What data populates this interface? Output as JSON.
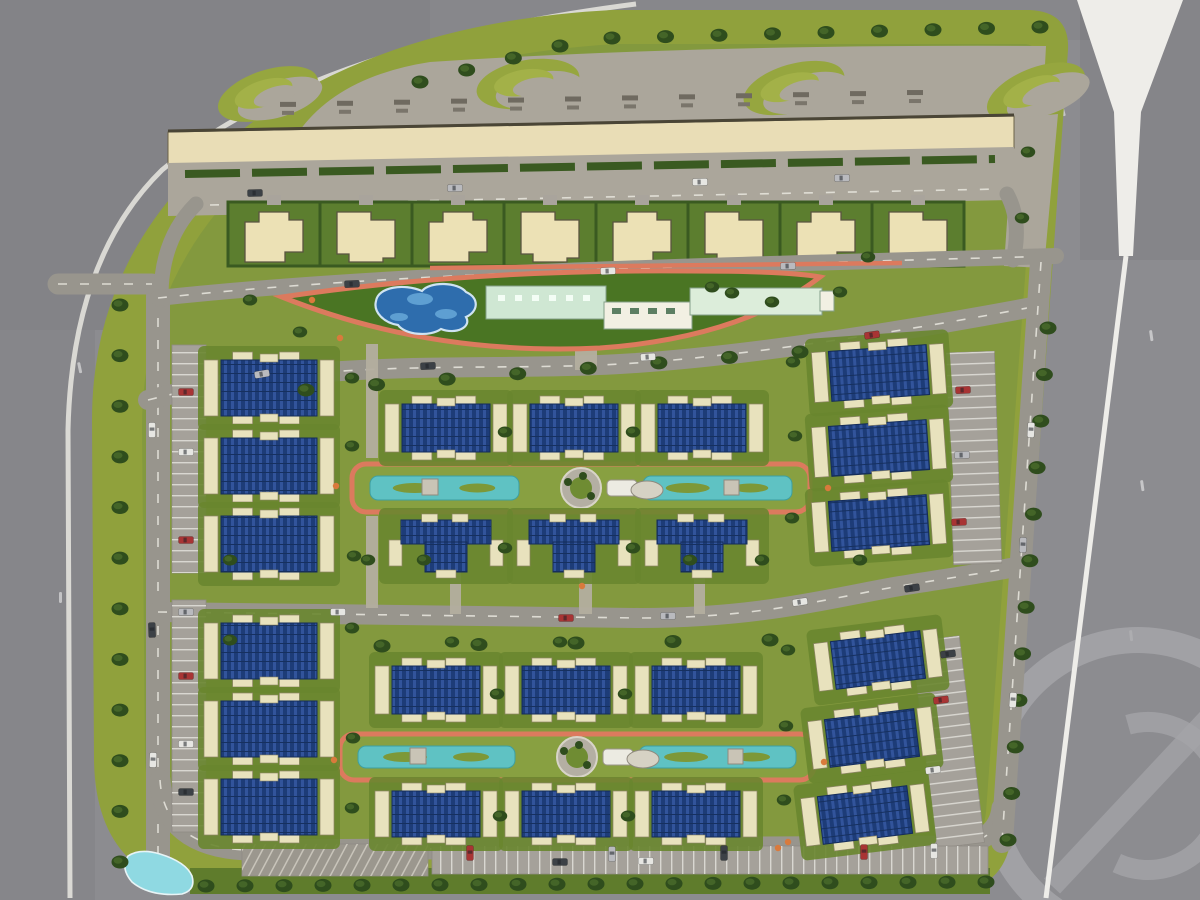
{
  "meta": {
    "description": "aerial master plan rendering of a gated residential compound",
    "canvas": {
      "w": 1200,
      "h": 900
    }
  },
  "colors": {
    "asphalt": "#8c8c90",
    "asphalt_dark": "#7e7e83",
    "belt_green": "#90a13c",
    "lawn": "#83993e",
    "lawn_dark": "#69862f",
    "amenity_lawn": "#4a7523",
    "hedge": "#3a5a21",
    "tree_dark": "#2f4d1d",
    "tree_mid": "#47682a",
    "paving": "#aba69b",
    "walkway": "#b3ae9f",
    "road": "#98958d",
    "road_dash": "#e9e7df",
    "curb_white": "#e9e7e0",
    "white_road": "#eeede9",
    "retail_beige": "#e9ddb6",
    "retail_edge": "#4a4536",
    "villa_tan": "#ece1b5",
    "villa_edge": "#5a5440",
    "villa_plot": "#5c7e2f",
    "bldg_cream": "#e8e2bd",
    "bldg_cream_edge": "#8d8566",
    "roof_navy": "#1d3c78",
    "roof_stripe": "#32549b",
    "roof_edge": "#142c5a",
    "track_orange": "#dc7a5e",
    "shrub_orange": "#d97a3c",
    "pool_blue": "#2e6dad",
    "pool_light": "#6aabdb",
    "pool_rim": "#cfe3f2",
    "canal_teal": "#5fc2c3",
    "canal_edge": "#3e9fa0",
    "park_lawn": "#88a041",
    "mint": "#cfe7d3",
    "mint2": "#dcedda",
    "club_white": "#f2f0e3",
    "club_edge": "#84a08a",
    "pond": "#8fd9e2",
    "pond_rim": "#e8f4f6",
    "lane": "#a5a19a",
    "stall_line": "#d9d7d1",
    "watermark": "#a6a6aa",
    "car": {
      "red": "#a83434",
      "white": "#e6e6e2",
      "silver": "#b9babe",
      "dark": "#3c4146",
      "green": "#31472a"
    }
  },
  "map": {
    "compound": "M 612,10 L 1030,10 Q 1070,12 1068,50 L 1012,830 Q 1008,890 948,893 L 235,893 Q 96,893 94,760 L 92,420 Q 92,240 250,124 Q 390,22 612,10 Z",
    "interior": "M 615,44 L 1026,44 Q 1041,46 1040,72 L 986,812 Q 982,850 944,852 L 250,852 Q 146,852 145,756 L 142,428 Q 142,256 286,146 Q 398,58 615,44 Z",
    "patches": [
      [
        0,
        0,
        430,
        330,
        0.06
      ],
      [
        0,
        330,
        95,
        570,
        0.04
      ],
      [
        1080,
        0,
        120,
        260,
        0.045
      ],
      [
        430,
        0,
        660,
        40,
        0.03
      ]
    ],
    "plaza": "M 300,130 Q 340,76 430,62 Q 700,44 1046,46 L 1042,122 L 1014,118 L 170,136 Z",
    "swirls": [
      [
        268,
        94,
        -18
      ],
      [
        528,
        84,
        -10
      ],
      [
        794,
        88,
        -16
      ],
      [
        1036,
        92,
        -22
      ]
    ],
    "labels": {
      "x0": 280,
      "step": 57,
      "n": 12
    },
    "retail": {
      "pts": "168,132 1014,116 1014,148 168,164",
      "topline": [
        [
          168,
          131
        ],
        [
          1014,
          115
        ]
      ]
    },
    "midband": {
      "pts": "168,163 1014,147 1012,200 168,216",
      "hedge": [
        [
          185,
          174
        ],
        [
          995,
          159
        ]
      ],
      "dash": [
        [
          210,
          205
        ],
        [
          1000,
          189
        ]
      ]
    },
    "villas": {
      "x0": 228,
      "step": 92,
      "n": 8,
      "y": 202,
      "h": 64
    },
    "pads": [
      "1014,118 1058,114 1044,268 1004,266"
    ],
    "amenity": {
      "lens": "M 282,297 Q 470,269 690,271 Q 790,271 820,277 Q 740,338 600,348 Q 430,356 282,297 Z",
      "topline": "M 430,268 L 902,263",
      "pool": "M 376,301 C 378,287 404,283 422,291 C 430,281 458,282 466,292 C 480,298 478,312 466,317 C 472,327 456,335 441,329 C 430,337 405,335 398,325 C 384,323 373,312 376,301 Z",
      "pool_inner": [
        [
          420,
          299,
          13,
          6
        ],
        [
          446,
          314,
          11,
          5
        ],
        [
          399,
          317,
          9,
          4
        ]
      ],
      "club": [
        [
          486,
          286,
          120,
          33,
          "m"
        ],
        [
          604,
          302,
          88,
          27,
          "w"
        ],
        [
          690,
          288,
          132,
          27,
          "m2"
        ],
        [
          820,
          291,
          14,
          20,
          "w"
        ]
      ]
    },
    "roads": [
      {
        "d": "M 158,296 L 158,862",
        "w": 24,
        "dash": 1
      },
      {
        "d": "M 58,284 L 152,284",
        "w": 21,
        "dash": 1
      },
      {
        "d": "M 196,204 Q 160,240 161,300",
        "w": 15
      },
      {
        "d": "M 1007,194 Q 1022,222 1013,260",
        "w": 15
      },
      {
        "d": "M 158,298 C 400,272 700,266 1056,256",
        "w": 16,
        "dash": 1
      },
      {
        "d": "M 148,400 C 320,356 480,372 620,364 C 740,357 900,332 1038,306",
        "w": 20,
        "dash": 1
      },
      {
        "d": "M 158,612 L 640,618 C 760,618 830,598 900,586 C 950,578 990,572 1010,568",
        "w": 20,
        "dash": 1
      },
      {
        "d": "M 160,780 Q 164,846 246,850 L 948,846 Q 998,844 1002,808",
        "w": 21,
        "dash": 1
      },
      {
        "d": "M 1041,262 L 1002,842",
        "w": 22,
        "dash": 1
      }
    ],
    "walkways": [
      [
        366,
        344,
        12,
        114
      ],
      [
        366,
        516,
        12,
        92
      ],
      [
        575,
        298,
        22,
        72
      ],
      [
        450,
        562,
        11,
        52
      ],
      [
        579,
        562,
        13,
        52
      ],
      [
        694,
        562,
        11,
        52
      ]
    ],
    "parks": [
      {
        "x": 352,
        "y": 464,
        "w": 458,
        "h": 48
      },
      {
        "x": 340,
        "y": 734,
        "w": 474,
        "h": 46
      }
    ],
    "parking": [
      {
        "x": 172,
        "y": 345,
        "w": 34,
        "h": 228,
        "o": "h"
      },
      {
        "x": 172,
        "y": 600,
        "w": 34,
        "h": 232,
        "o": "h"
      },
      {
        "x": 950,
        "y": 352,
        "w": 48,
        "h": 212,
        "o": "h",
        "r": -2
      },
      {
        "x": 924,
        "y": 638,
        "w": 48,
        "h": 208,
        "o": "h",
        "r": -7
      },
      {
        "x": 432,
        "y": 846,
        "w": 556,
        "h": 28,
        "o": "v"
      },
      {
        "x": 242,
        "y": 844,
        "w": 186,
        "h": 32,
        "o": "x"
      }
    ],
    "buildings": [
      {
        "t": "f",
        "x": 204,
        "y": 352,
        "w": 130,
        "h": 72,
        "r": 0
      },
      {
        "t": "f",
        "x": 204,
        "y": 430,
        "w": 130,
        "h": 72,
        "r": 0
      },
      {
        "t": "f",
        "x": 204,
        "y": 508,
        "w": 130,
        "h": 72,
        "r": 0
      },
      {
        "t": "f",
        "x": 204,
        "y": 615,
        "w": 130,
        "h": 72,
        "r": 0
      },
      {
        "t": "f",
        "x": 204,
        "y": 693,
        "w": 130,
        "h": 72,
        "r": 0
      },
      {
        "t": "f",
        "x": 204,
        "y": 771,
        "w": 130,
        "h": 72,
        "r": 0
      },
      {
        "t": "f",
        "x": 385,
        "y": 396,
        "w": 122,
        "h": 64,
        "r": 0
      },
      {
        "t": "f",
        "x": 513,
        "y": 396,
        "w": 122,
        "h": 64,
        "r": 0
      },
      {
        "t": "f",
        "x": 641,
        "y": 396,
        "w": 122,
        "h": 64,
        "r": 0
      },
      {
        "t": "c",
        "x": 385,
        "y": 514,
        "w": 122,
        "h": 64,
        "r": 0
      },
      {
        "t": "c",
        "x": 513,
        "y": 514,
        "w": 122,
        "h": 64,
        "r": 0
      },
      {
        "t": "c",
        "x": 641,
        "y": 514,
        "w": 122,
        "h": 64,
        "r": 0
      },
      {
        "t": "f",
        "x": 375,
        "y": 658,
        "w": 122,
        "h": 64,
        "r": 0
      },
      {
        "t": "f",
        "x": 505,
        "y": 658,
        "w": 122,
        "h": 64,
        "r": 0
      },
      {
        "t": "f",
        "x": 635,
        "y": 658,
        "w": 122,
        "h": 64,
        "r": 0
      },
      {
        "t": "f",
        "x": 375,
        "y": 783,
        "w": 122,
        "h": 62,
        "r": 0
      },
      {
        "t": "f",
        "x": 505,
        "y": 783,
        "w": 122,
        "h": 62,
        "r": 0
      },
      {
        "t": "f",
        "x": 635,
        "y": 783,
        "w": 122,
        "h": 62,
        "r": 0
      },
      {
        "t": "f",
        "x": 813,
        "y": 340,
        "w": 132,
        "h": 66,
        "r": -4
      },
      {
        "t": "f",
        "x": 813,
        "y": 415,
        "w": 132,
        "h": 66,
        "r": -4
      },
      {
        "t": "f",
        "x": 813,
        "y": 490,
        "w": 132,
        "h": 66,
        "r": -4
      },
      {
        "t": "f",
        "x": 816,
        "y": 628,
        "w": 124,
        "h": 64,
        "r": -7
      },
      {
        "t": "f",
        "x": 810,
        "y": 706,
        "w": 124,
        "h": 64,
        "r": -7
      },
      {
        "t": "f",
        "x": 803,
        "y": 783,
        "w": 124,
        "h": 64,
        "r": -7
      }
    ],
    "pond": "M 128,856 Q 120,868 132,882 Q 150,897 182,894 Q 196,890 192,876 Q 186,862 160,854 Q 140,848 128,856 Z",
    "bottomstrip": [
      190,
      868,
      800,
      26
    ],
    "whiteroad": {
      "trumpet": "1077,0 1183,0 1141,112 1133,256 1119,256 1114,112",
      "line": "M 1126,256 L 1046,898",
      "lw": 5
    },
    "curb": "M 636,4 Q 310,46 162,170 Q 72,258 68,430 L 70,898",
    "watermark": {
      "cx": 1138,
      "cy": 788,
      "r": 148,
      "r2": 74
    },
    "trees": {
      "rows": [
        {
          "a": [
            420,
            82
          ],
          "b": [
            560,
            46
          ],
          "n": 4
        },
        {
          "a": [
            612,
            38
          ],
          "b": [
            1040,
            27
          ],
          "n": 9
        },
        {
          "a": [
            120,
            305
          ],
          "b": [
            120,
            862
          ],
          "n": 12
        },
        {
          "a": [
            1048,
            328
          ],
          "b": [
            1008,
            840
          ],
          "n": 12
        },
        {
          "a": [
            206,
            886
          ],
          "b": [
            986,
            882
          ],
          "n": 21
        },
        {
          "a": [
            306,
            390
          ],
          "b": [
            800,
            352
          ],
          "n": 8
        },
        {
          "a": [
            382,
            646
          ],
          "b": [
            770,
            640
          ],
          "n": 5
        }
      ],
      "scatter": [
        [
          352,
          378
        ],
        [
          352,
          446
        ],
        [
          354,
          556
        ],
        [
          352,
          628
        ],
        [
          353,
          738
        ],
        [
          352,
          808
        ],
        [
          793,
          362
        ],
        [
          795,
          436
        ],
        [
          792,
          518
        ],
        [
          788,
          650
        ],
        [
          786,
          726
        ],
        [
          784,
          800
        ],
        [
          505,
          432
        ],
        [
          633,
          432
        ],
        [
          505,
          548
        ],
        [
          633,
          548
        ],
        [
          497,
          694
        ],
        [
          625,
          694
        ],
        [
          500,
          816
        ],
        [
          628,
          816
        ],
        [
          368,
          560
        ],
        [
          762,
          560
        ],
        [
          300,
          332
        ],
        [
          772,
          302
        ],
        [
          840,
          292
        ],
        [
          712,
          287
        ],
        [
          732,
          293
        ],
        [
          868,
          257
        ],
        [
          424,
          560
        ],
        [
          690,
          560
        ],
        [
          560,
          642
        ],
        [
          452,
          642
        ],
        [
          860,
          560
        ],
        [
          1028,
          152
        ],
        [
          1022,
          218
        ],
        [
          250,
          300
        ],
        [
          230,
          560
        ],
        [
          230,
          640
        ]
      ]
    },
    "cars": [
      [
        186,
        392,
        0,
        "red"
      ],
      [
        186,
        452,
        0,
        "white"
      ],
      [
        186,
        540,
        0,
        "red"
      ],
      [
        186,
        612,
        0,
        "silver"
      ],
      [
        186,
        676,
        0,
        "red"
      ],
      [
        186,
        744,
        0,
        "white"
      ],
      [
        186,
        792,
        0,
        "dark"
      ],
      [
        152,
        430,
        90,
        "white"
      ],
      [
        152,
        630,
        88,
        "dark"
      ],
      [
        153,
        760,
        92,
        "white"
      ],
      [
        963,
        390,
        -2,
        "red"
      ],
      [
        962,
        455,
        -2,
        "silver"
      ],
      [
        959,
        522,
        -2,
        "red"
      ],
      [
        941,
        700,
        -7,
        "red"
      ],
      [
        933,
        770,
        -7,
        "white"
      ],
      [
        948,
        654,
        -7,
        "dark"
      ],
      [
        470,
        853,
        90,
        "red"
      ],
      [
        612,
        854,
        90,
        "silver"
      ],
      [
        724,
        853,
        90,
        "dark"
      ],
      [
        864,
        852,
        90,
        "red"
      ],
      [
        934,
        851,
        90,
        "white"
      ],
      [
        255,
        193,
        -1,
        "dark"
      ],
      [
        455,
        188,
        -1,
        "silver"
      ],
      [
        700,
        182,
        -1,
        "white"
      ],
      [
        842,
        178,
        -1,
        "silver"
      ],
      [
        352,
        284,
        -3,
        "dark"
      ],
      [
        608,
        271,
        -2,
        "white"
      ],
      [
        788,
        266,
        -2,
        "silver"
      ],
      [
        262,
        374,
        -10,
        "silver"
      ],
      [
        428,
        366,
        -3,
        "dark"
      ],
      [
        648,
        357,
        -4,
        "white"
      ],
      [
        872,
        335,
        -8,
        "red"
      ],
      [
        338,
        612,
        0,
        "white"
      ],
      [
        566,
        618,
        0,
        "red"
      ],
      [
        668,
        616,
        0,
        "silver"
      ],
      [
        800,
        602,
        -8,
        "white"
      ],
      [
        912,
        588,
        -8,
        "dark"
      ],
      [
        1031,
        430,
        93,
        "white"
      ],
      [
        1023,
        545,
        93,
        "silver"
      ],
      [
        1013,
        700,
        94,
        "white"
      ],
      [
        560,
        862,
        0,
        "dark"
      ],
      [
        646,
        861,
        0,
        "white"
      ]
    ],
    "dots": [
      [
        340,
        338
      ],
      [
        312,
        300
      ],
      [
        828,
        488
      ],
      [
        336,
        486
      ],
      [
        824,
        762
      ],
      [
        334,
        760
      ],
      [
        582,
        586
      ],
      [
        788,
        842
      ],
      [
        778,
        848
      ]
    ],
    "dashes": [
      [
        1063,
        105,
        75
      ],
      [
        1152,
        330,
        82
      ],
      [
        1143,
        480,
        82
      ],
      [
        1132,
        630,
        84
      ],
      [
        897,
        430,
        86
      ],
      [
        940,
        552,
        86
      ],
      [
        888,
        700,
        88
      ],
      [
        760,
        120,
        2
      ],
      [
        62,
        592,
        90
      ],
      [
        80,
        362,
        78
      ]
    ]
  }
}
